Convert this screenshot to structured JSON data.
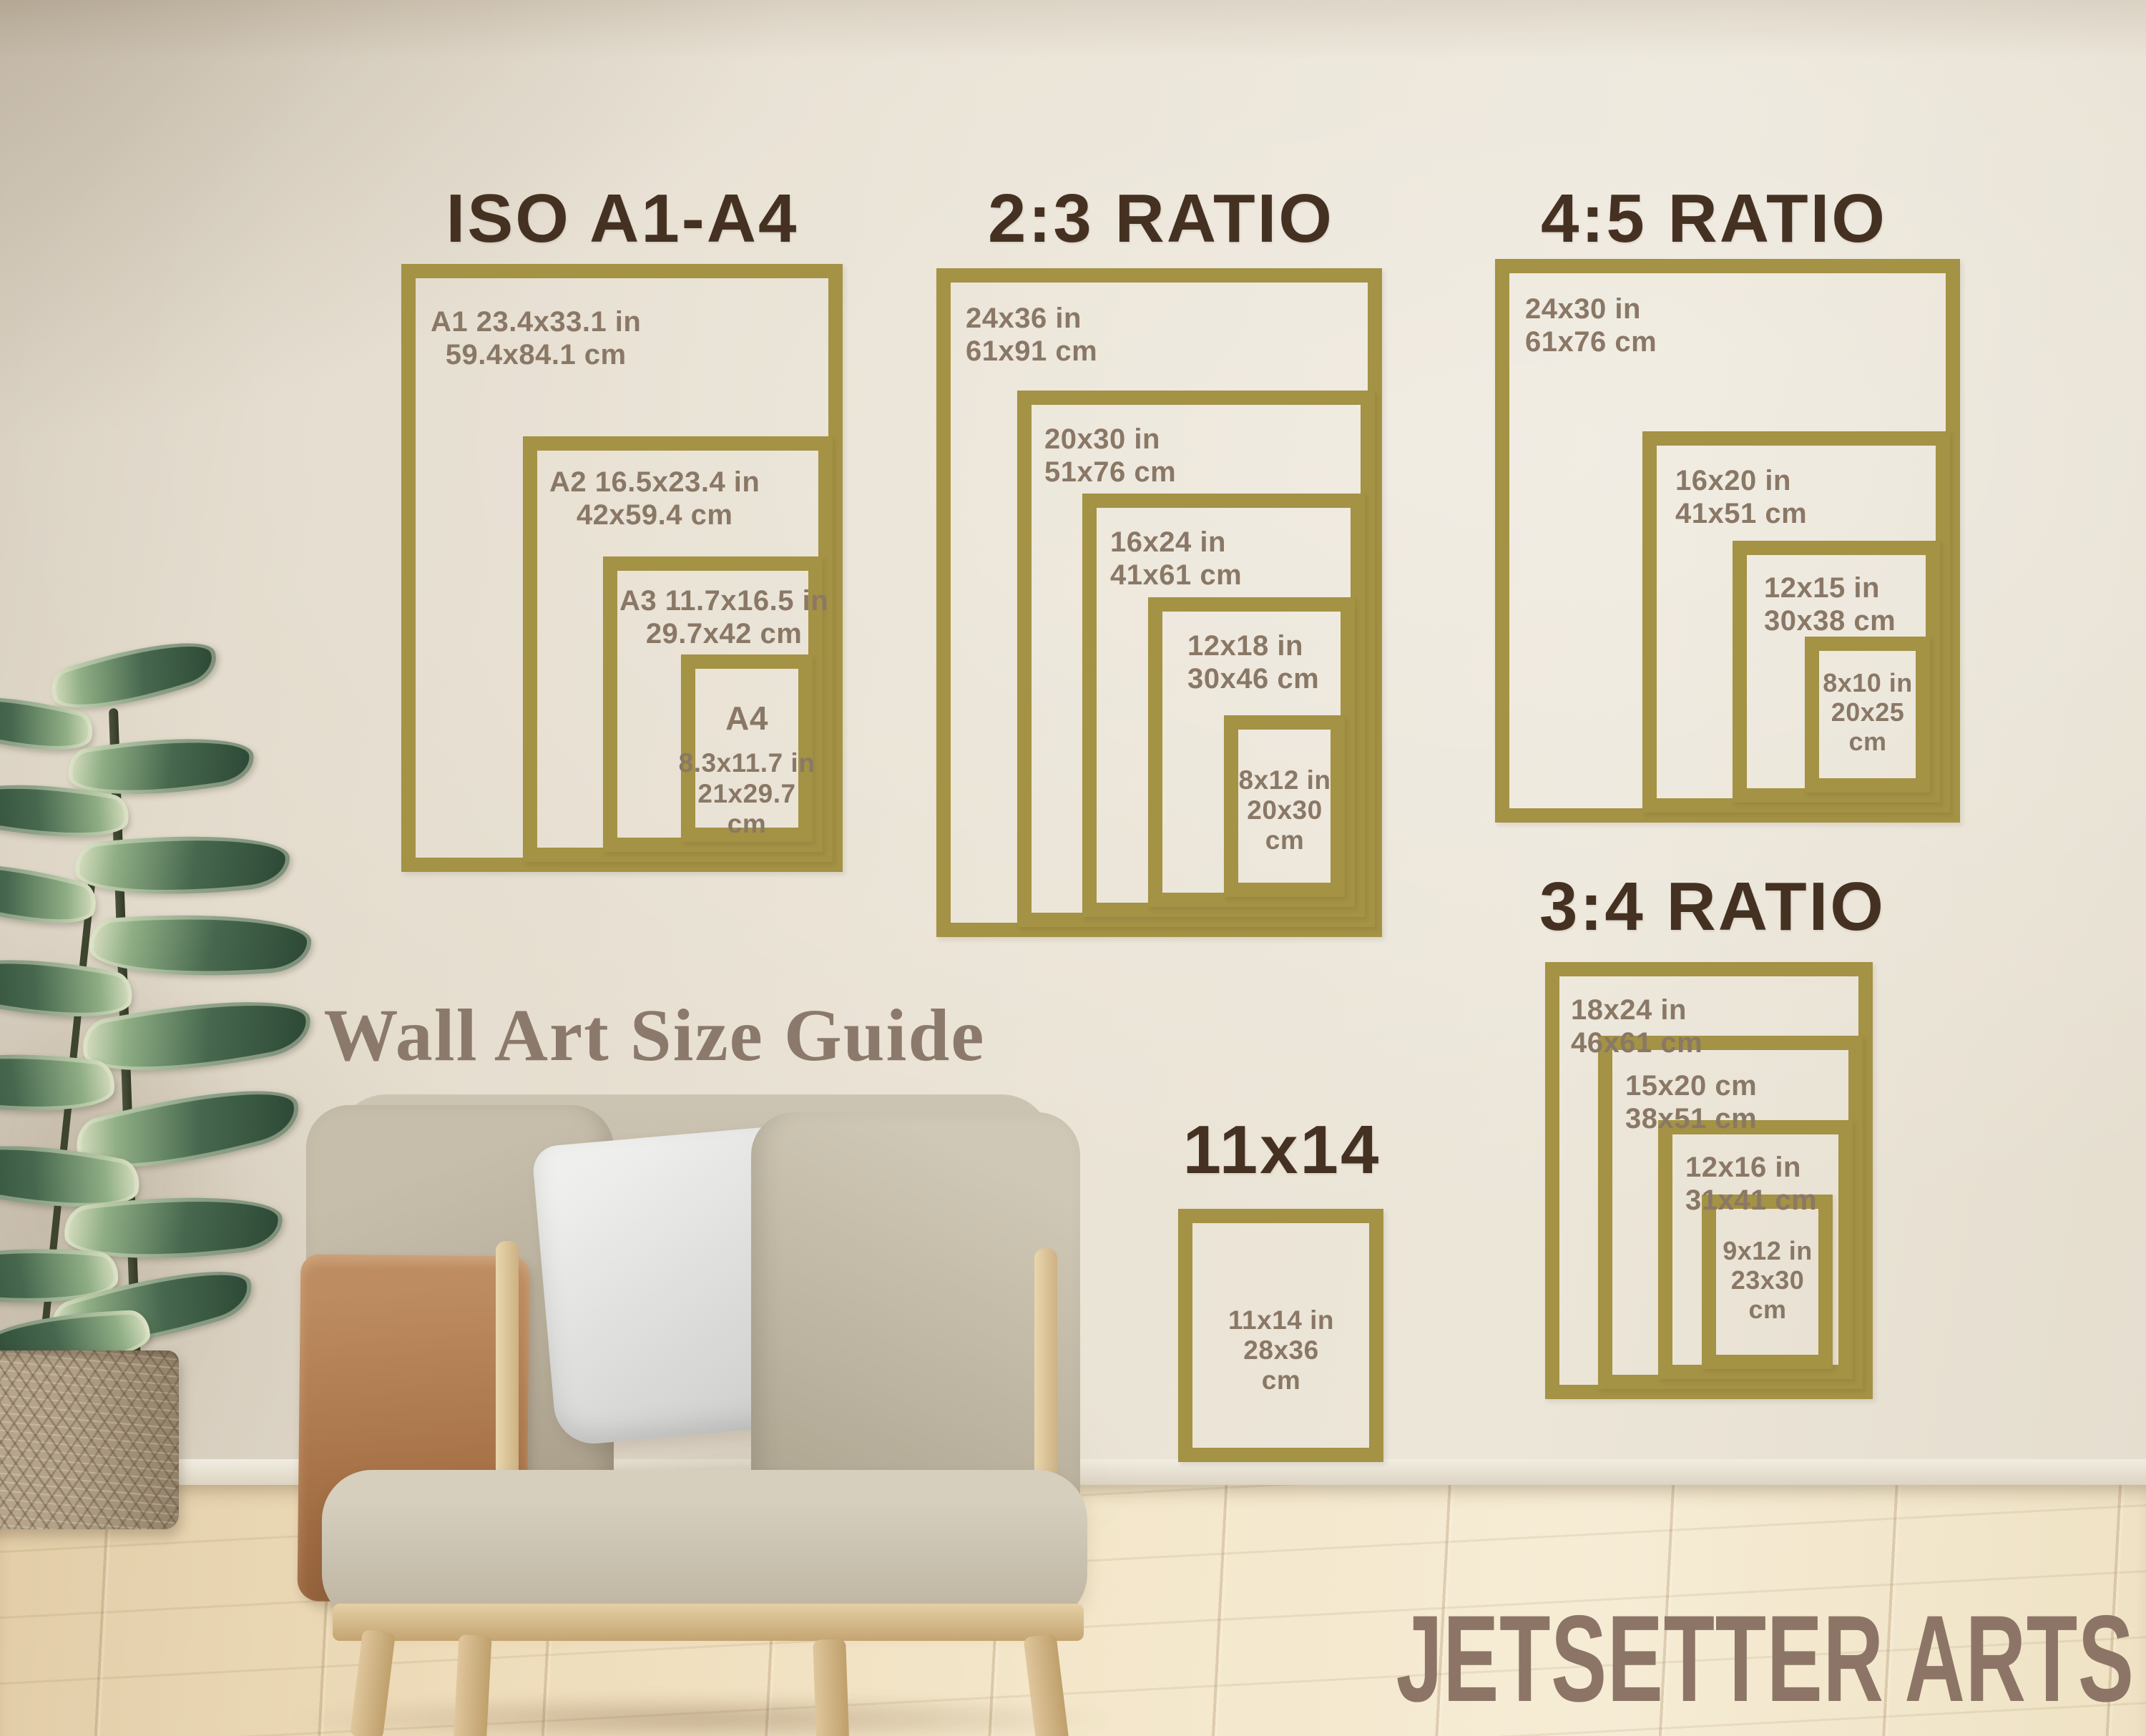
{
  "guide_title": "Wall Art Size Guide",
  "brand": "JETSETTER ARTS",
  "colors": {
    "frame_gold": "#a49245",
    "section_title_brown": "#453122",
    "label_taupe": "#8a7866",
    "guide_title_color": "#8b7a6b",
    "brand_color": "#8c7566"
  },
  "sections": [
    {
      "id": "iso-a1-a4",
      "title": "ISO A1-A4",
      "frames": [
        {
          "name": "A1",
          "lines": [
            "A1 23.4x33.1 in",
            "59.4x84.1 cm"
          ]
        },
        {
          "name": "A2",
          "lines": [
            "A2 16.5x23.4 in",
            "42x59.4 cm"
          ]
        },
        {
          "name": "A3",
          "lines": [
            "A3 11.7x16.5 in",
            "29.7x42 cm"
          ]
        },
        {
          "name": "A4",
          "heading": "A4",
          "lines": [
            "8.3x11.7 in",
            "21x29.7",
            "cm"
          ]
        }
      ]
    },
    {
      "id": "ratio-2-3",
      "title": "2:3 RATIO",
      "frames": [
        {
          "name": "24x36",
          "lines": [
            "24x36 in",
            "61x91 cm"
          ]
        },
        {
          "name": "20x30",
          "lines": [
            "20x30 in",
            "51x76 cm"
          ]
        },
        {
          "name": "16x24",
          "lines": [
            "16x24 in",
            "41x61 cm"
          ]
        },
        {
          "name": "12x18",
          "lines": [
            "12x18 in",
            "30x46 cm"
          ]
        },
        {
          "name": "8x12",
          "lines": [
            "8x12 in",
            "20x30",
            "cm"
          ]
        }
      ]
    },
    {
      "id": "ratio-4-5",
      "title": "4:5 RATIO",
      "frames": [
        {
          "name": "24x30",
          "lines": [
            "24x30 in",
            "61x76 cm"
          ]
        },
        {
          "name": "16x20",
          "lines": [
            "16x20 in",
            "41x51 cm"
          ]
        },
        {
          "name": "12x15",
          "lines": [
            "12x15 in",
            "30x38 cm"
          ]
        },
        {
          "name": "8x10",
          "lines": [
            "8x10 in",
            "20x25",
            "cm"
          ]
        }
      ]
    },
    {
      "id": "ratio-3-4",
      "title": "3:4 RATIO",
      "frames": [
        {
          "name": "18x24",
          "lines": [
            "18x24 in",
            "46x61 cm"
          ]
        },
        {
          "name": "15x20",
          "lines": [
            "15x20 cm",
            "38x51 cm"
          ]
        },
        {
          "name": "12x16",
          "lines": [
            "12x16 in",
            "31x41 cm"
          ]
        },
        {
          "name": "9x12",
          "lines": [
            "9x12 in",
            "23x30",
            "cm"
          ]
        }
      ]
    },
    {
      "id": "size-11x14",
      "title": "11x14",
      "frames": [
        {
          "name": "11x14",
          "lines": [
            "11x14 in",
            "28x36",
            "cm"
          ]
        }
      ]
    }
  ]
}
